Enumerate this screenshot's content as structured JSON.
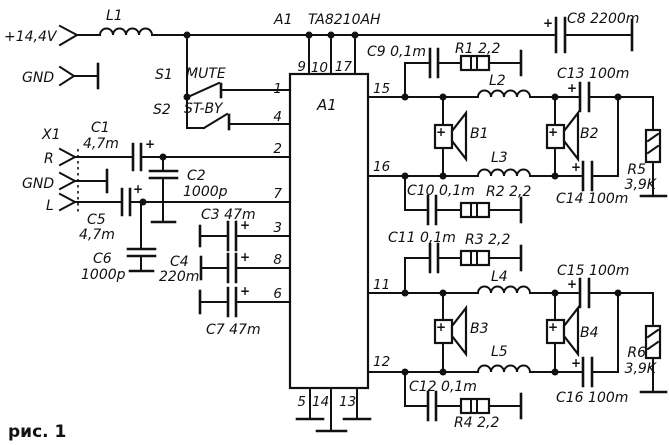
{
  "caption": "рис. 1",
  "symbols": {
    "plus": "+"
  },
  "title": {
    "ref": "A1",
    "part": "TA8210AH"
  },
  "power": {
    "supply_label": "+14,4V",
    "gnd_label": "GND",
    "l1": "L1",
    "c8": "C8 2200m"
  },
  "switches": {
    "s1_ref": "S1",
    "s1_name": "MUTE",
    "s2_ref": "S2",
    "s2_name": "ST-BY"
  },
  "input": {
    "connector": "X1",
    "r": "R",
    "gnd": "GND",
    "l": "L",
    "c1_ref": "C1",
    "c1_val": "4,7m",
    "c2_ref": "C2",
    "c2_val": "1000p",
    "c5_ref": "C5",
    "c5_val": "4,7m",
    "c6_ref": "C6",
    "c6_val": "1000p",
    "c3": "C3 47m",
    "c4_ref": "C4",
    "c4_val": "220m",
    "c7": "C7 47m"
  },
  "ic": {
    "label": "A1",
    "pins_top": [
      "9",
      "10",
      "17"
    ],
    "pins_left": [
      "1",
      "4",
      "2",
      "7",
      "3",
      "8",
      "6"
    ],
    "pins_right": [
      "15",
      "16",
      "11",
      "12"
    ],
    "pins_bottom": [
      "5",
      "14",
      "13"
    ]
  },
  "ch1": {
    "c9": "C9 0,1m",
    "r1": "R1 2,2",
    "c10": "C10 0,1m",
    "r2": "R2 2,2",
    "l2": "L2",
    "l3": "L3",
    "b1": "B1",
    "b2": "B2",
    "c13": "C13 100m",
    "c14": "C14 100m",
    "r5_ref": "R5",
    "r5_val": "3,9K"
  },
  "ch2": {
    "c11": "C11 0,1m",
    "r3": "R3 2,2",
    "c12": "C12 0,1m",
    "r4": "R4 2,2",
    "l4": "L4",
    "l5": "L5",
    "b3": "B3",
    "b4": "B4",
    "c15": "C15 100m",
    "c16": "C16 100m",
    "r6_ref": "R6",
    "r6_val": "3,9K"
  }
}
